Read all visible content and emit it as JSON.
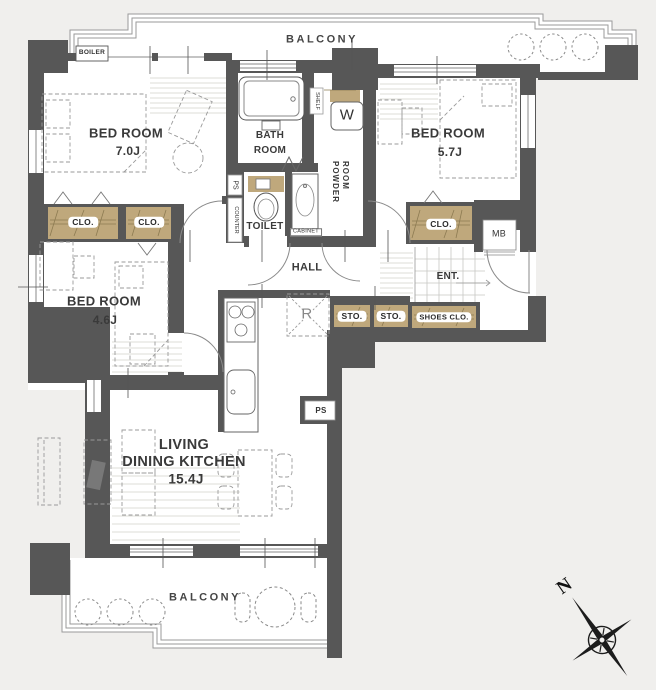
{
  "labels": {
    "balcony_top": "BALCONY",
    "balcony_bottom": "BALCONY",
    "boiler": "BOILER",
    "bed1_name": "BED ROOM",
    "bed1_size": "7.0J",
    "bed2_name": "BED ROOM",
    "bed2_size": "5.7J",
    "bed3_name": "BED ROOM",
    "bed3_size": "4.6J",
    "ldk_line1": "LIVING",
    "ldk_line2": "DINING KITCHEN",
    "ldk_size": "15.4J",
    "bath_line1": "BATH",
    "bath_line2": "ROOM",
    "powder_line1": "POWDER",
    "powder_line2": "ROOM",
    "toilet": "TOILET",
    "hall": "HALL",
    "ent": "ENT.",
    "mb": "MB",
    "washer": "W",
    "refrigerator": "R",
    "shelf": "SHELF",
    "counter": "COUNTER",
    "cabinet": "CABINET",
    "ps_top": "PS",
    "ps_right": "PS",
    "clo_a": "CLO.",
    "clo_b": "CLO.",
    "clo_c": "CLO.",
    "sto_a": "STO.",
    "sto_b": "STO.",
    "shoes_clo": "SHOES CLO.",
    "north": "N"
  },
  "colors": {
    "background": "#f0efed",
    "wall": "#575757",
    "floor": "#ffffff",
    "closet_fill": "#bfa87c",
    "closet_line": "#8d7b52",
    "thin_line": "#8a8a8a"
  }
}
